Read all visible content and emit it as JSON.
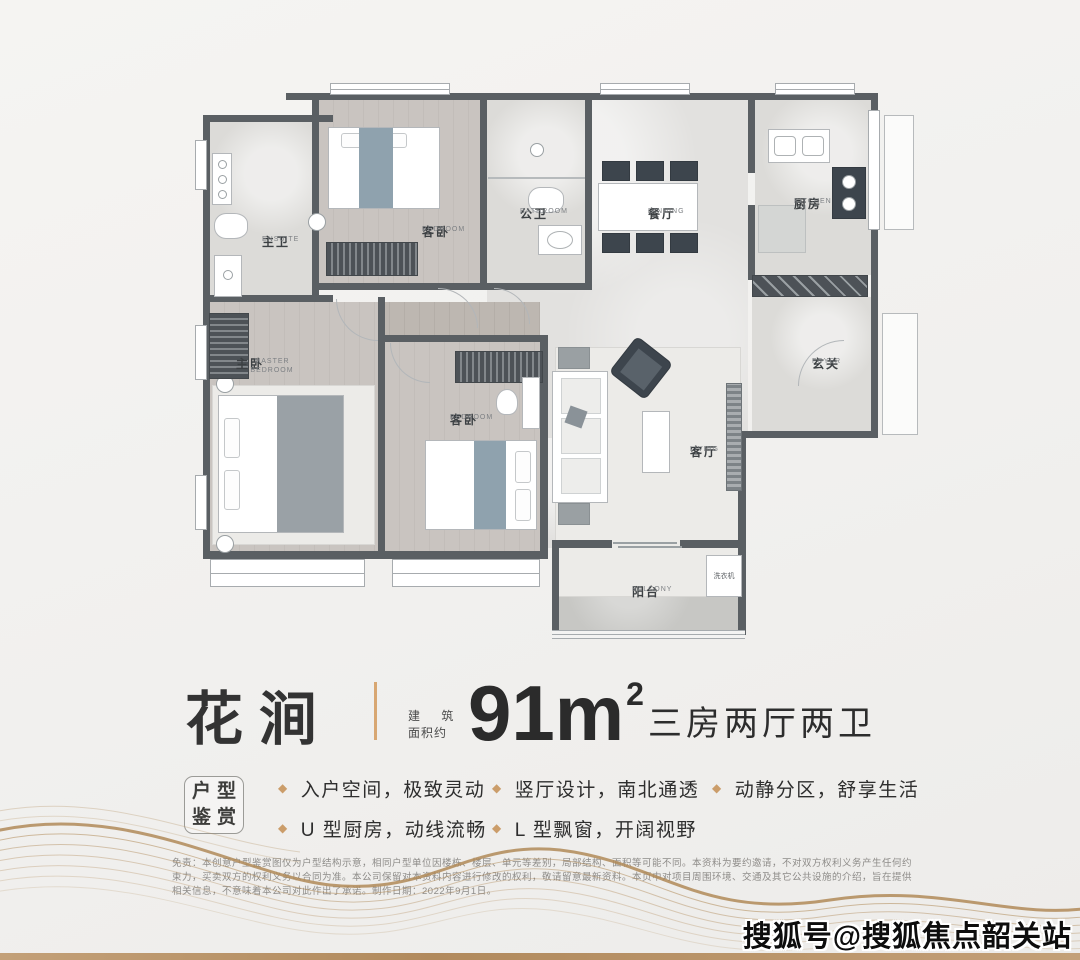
{
  "title": {
    "name": "花涧",
    "area_label_line1": "建 筑",
    "area_label_line2": "面积约",
    "area_value": "91m",
    "area_sup": "2",
    "layout": "三房两厅两卫",
    "accent_color": "#d8a772"
  },
  "features": {
    "box_line1": "户型",
    "box_line2": "鉴赏",
    "bullet": "◆",
    "bullet_color": "#cb9d6a",
    "columns": [
      {
        "items": [
          "入户空间，极致灵动",
          "U 型厨房，动线流畅"
        ]
      },
      {
        "items": [
          "竖厅设计，南北通透",
          "L 型飘窗，开阔视野"
        ]
      },
      {
        "items": [
          "动静分区，舒享生活"
        ]
      }
    ]
  },
  "floorplan": {
    "wall_color": "#5a5f63",
    "rooms": [
      {
        "cn": "主卫",
        "en": "ENSUITE"
      },
      {
        "cn": "客卧",
        "en": "BEDROOM"
      },
      {
        "cn": "公卫",
        "en": "BATHROOM"
      },
      {
        "cn": "餐厅",
        "en": "DINNING"
      },
      {
        "cn": "厨房",
        "en": "KITCHEN"
      },
      {
        "cn": "玄关",
        "en": "FOYER"
      },
      {
        "cn": "主卧",
        "en": "MASTER BEDROOM"
      },
      {
        "cn": "客卧",
        "en": "BEDROOM"
      },
      {
        "cn": "客厅",
        "en": "LIVING"
      },
      {
        "cn": "阳台",
        "en": "BALCONY"
      },
      {
        "cn": "洗衣机",
        "en": ""
      }
    ]
  },
  "disclaimer": {
    "text": "免责：本创意户型鉴赏图仅为户型结构示意，相同户型单位因楼栋、楼层、单元等差别，局部结构、面积等可能不同。本资料为要约邀请，不对双方权利义务产生任何约束力，买卖双方的权利义务以合同为准。本公司保留对本资料内容进行修改的权利，敬请留意最新资料。本页中对项目周围环境、交通及其它公共设施的介绍，旨在提供相关信息，不意味着本公司对此作出了承诺。制作日期：2022年9月1日。"
  },
  "watermark": {
    "text": "搜狐号@搜狐焦点韶关站"
  }
}
